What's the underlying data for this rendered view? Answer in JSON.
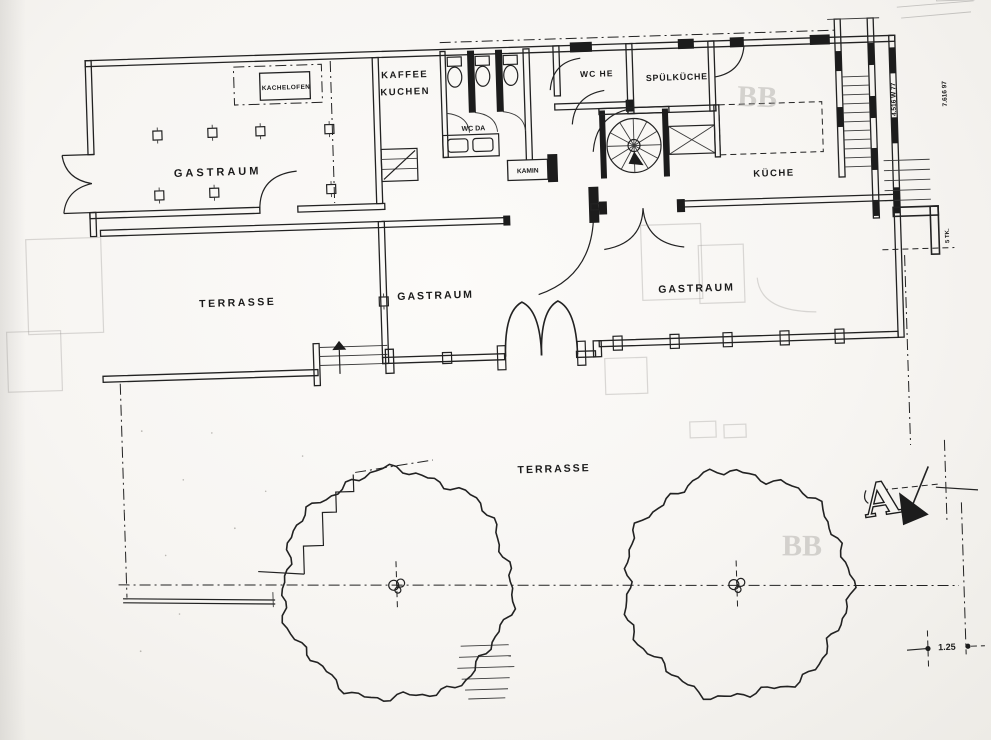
{
  "drawing": {
    "section_marker": {
      "letter": "A"
    },
    "annotations": [
      {
        "id": "room-gastraum-left",
        "text": "GASTRAUM",
        "x": 224,
        "y": 167,
        "size": 11,
        "ls": 3
      },
      {
        "id": "kachelofen",
        "text": "KACHELOFEN",
        "x": 295,
        "y": 83,
        "size": 6.4,
        "ls": 0.4
      },
      {
        "id": "kaffee",
        "text": "KAFFEE",
        "x": 414,
        "y": 75,
        "size": 9.5,
        "ls": 1.5
      },
      {
        "id": "kuchen",
        "text": "KUCHEN",
        "x": 414,
        "y": 92,
        "size": 9.5,
        "ls": 1.5
      },
      {
        "id": "wc-da",
        "text": "WC DA",
        "x": 481,
        "y": 130,
        "size": 7
      },
      {
        "id": "wc-he",
        "text": "WC HE",
        "x": 606,
        "y": 80,
        "size": 8.5,
        "ls": 1
      },
      {
        "id": "spuelkueche",
        "text": "SPÜLKÜCHE",
        "x": 686,
        "y": 86,
        "size": 8.8,
        "ls": 0.8
      },
      {
        "id": "kamin",
        "text": "KAMIN",
        "x": 534,
        "y": 174,
        "size": 6.6
      },
      {
        "id": "kueche",
        "text": "KÜCHE",
        "x": 780,
        "y": 185,
        "size": 9.5,
        "ls": 1.5
      },
      {
        "id": "terrasse-upper",
        "text": "TERRASSE",
        "x": 240,
        "y": 298,
        "size": 10.5,
        "ls": 2.5
      },
      {
        "id": "room-gastraum-mid",
        "text": "GASTRAUM",
        "x": 438,
        "y": 297,
        "size": 10.5,
        "ls": 2
      },
      {
        "id": "room-gastraum-right",
        "text": "GASTRAUM",
        "x": 699,
        "y": 298,
        "size": 10.5,
        "ls": 2
      },
      {
        "id": "terrasse-lower",
        "text": "TERRASSE",
        "x": 551,
        "y": 474,
        "size": 10.5,
        "ls": 2
      },
      {
        "id": "dim-1",
        "text": "4.516 W 77",
        "x": 904,
        "y": 112,
        "size": 6.5,
        "rot": -90
      },
      {
        "id": "dim-2",
        "text": "7.616 97",
        "x": 955,
        "y": 108,
        "size": 6.5,
        "rot": -90
      },
      {
        "id": "dim-3",
        "text": "5 TK.",
        "x": 953,
        "y": 250,
        "size": 6,
        "rot": -90
      },
      {
        "id": "scale-note",
        "text": "1.25",
        "x": 938,
        "y": 664,
        "size": 9
      }
    ],
    "ghost_texts": [
      {
        "id": "ghost-bb-top",
        "text": "BB",
        "x": 765,
        "y": 115,
        "size": 30,
        "rot": 4
      },
      {
        "id": "ghost-bb-bottom",
        "text": "BB",
        "x": 796,
        "y": 565,
        "size": 30,
        "rot": 2
      }
    ]
  }
}
